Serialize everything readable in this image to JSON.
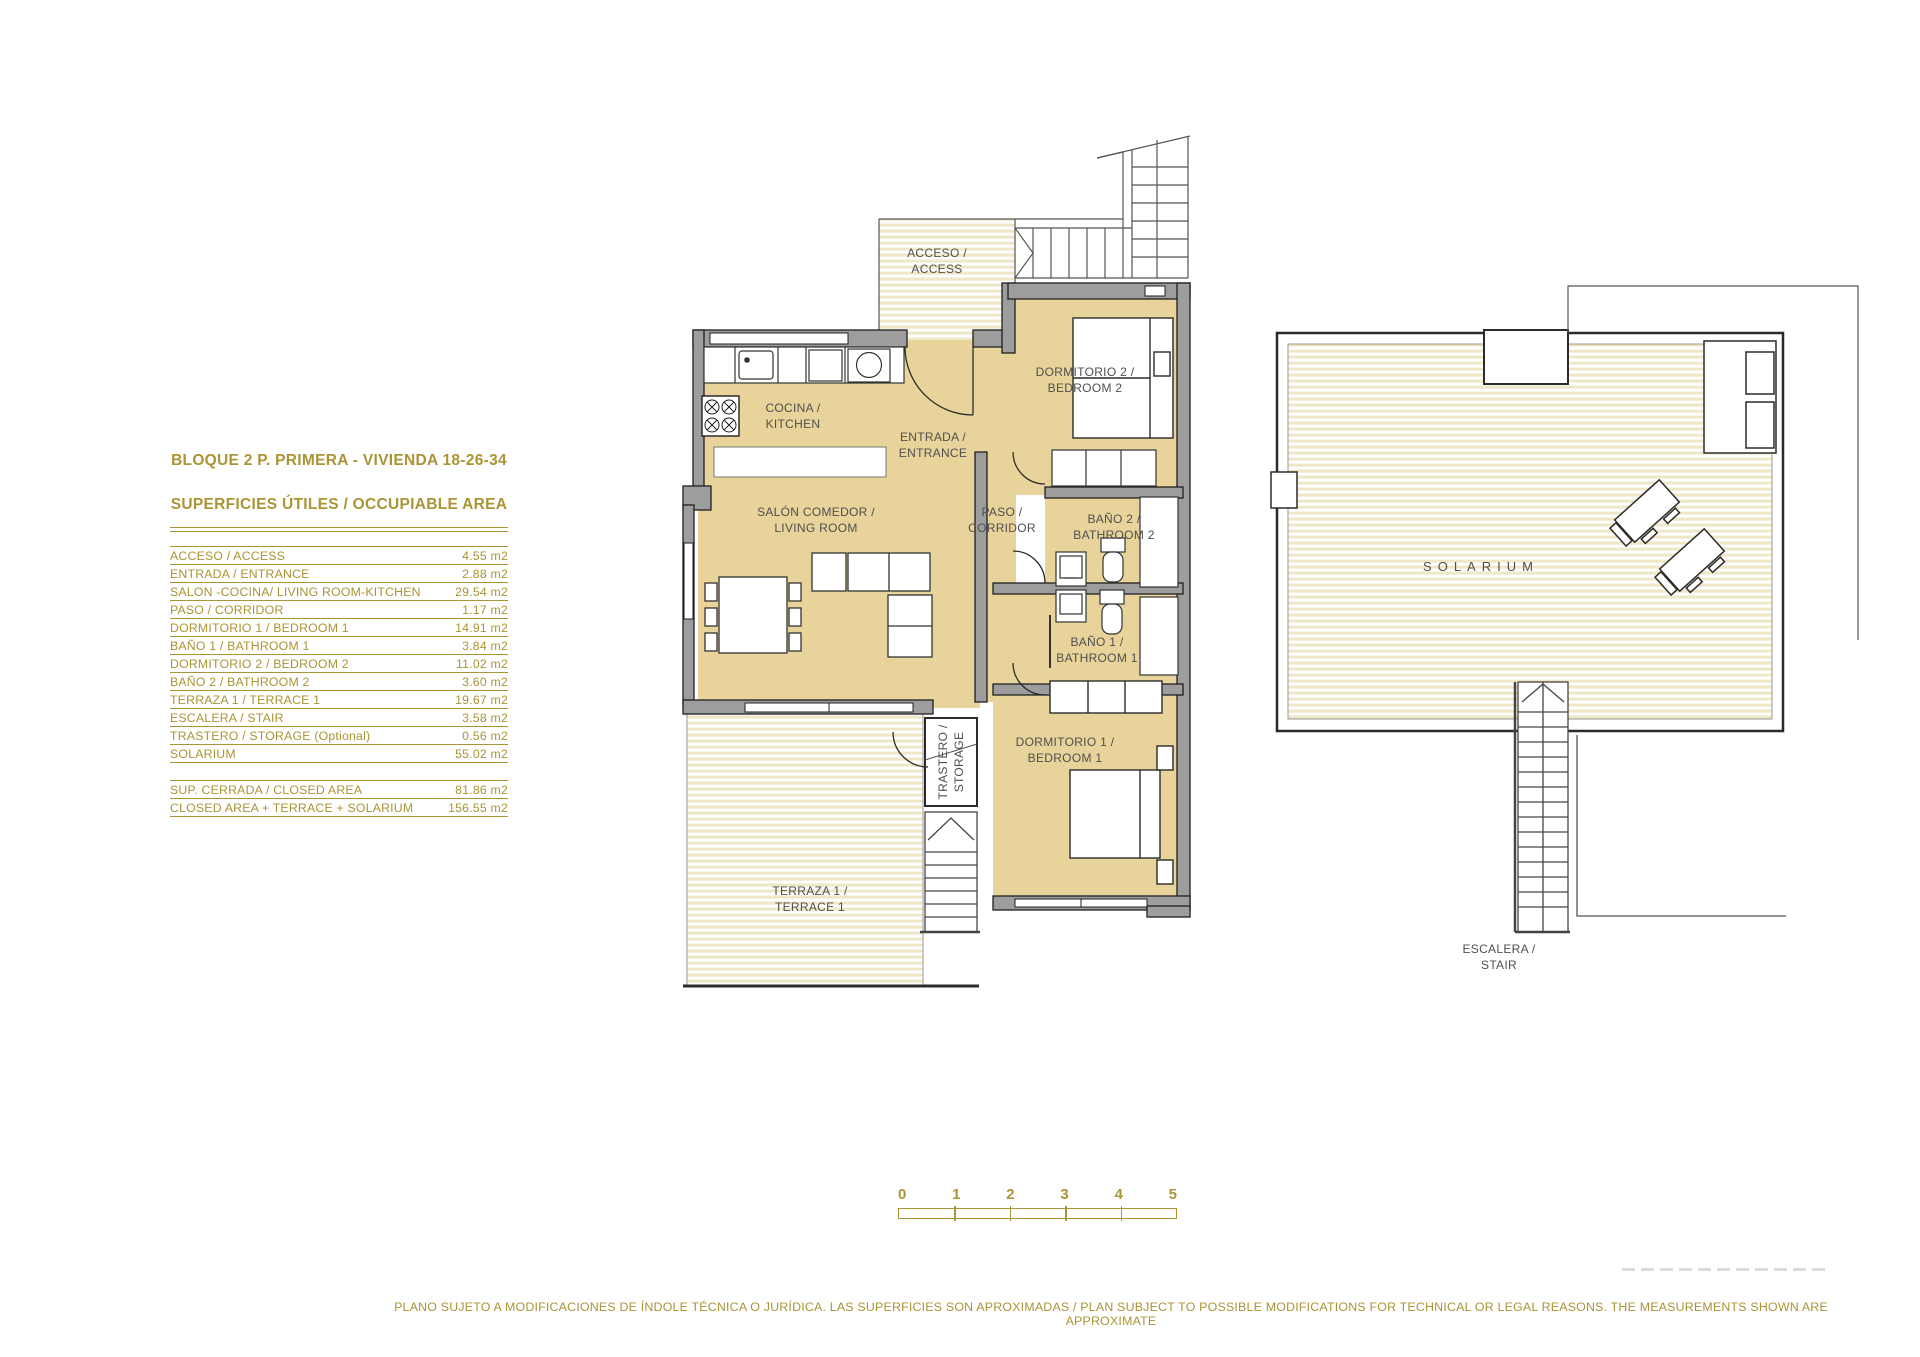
{
  "title": {
    "line1": "BLOQUE 2  P. PRIMERA - VIVIENDA 18-26-34",
    "line2": "SUPERFICIES ÚTILES / OCCUPIABLE  AREA"
  },
  "area_table": {
    "rows": [
      {
        "label": "ACCESO / ACCESS",
        "value": "4.55 m2"
      },
      {
        "label": "ENTRADA / ENTRANCE",
        "value": "2.88 m2"
      },
      {
        "label": "SALON -COCINA/ LIVING ROOM-KITCHEN",
        "value": "29.54 m2"
      },
      {
        "label": "PASO / CORRIDOR",
        "value": "1.17 m2"
      },
      {
        "label": "DORMITORIO 1 /  BEDROOM 1",
        "value": "14.91 m2"
      },
      {
        "label": "BAÑO 1 / BATHROOM 1",
        "value": "3.84 m2"
      },
      {
        "label": "DORMITORIO 2 / BEDROOM 2",
        "value": "11.02 m2"
      },
      {
        "label": "BAÑO 2 / BATHROOM 2",
        "value": "3.60 m2"
      },
      {
        "label": "TERRAZA 1 / TERRACE 1",
        "value": "19.67 m2"
      },
      {
        "label": "ESCALERA / STAIR",
        "value": "3.58 m2"
      },
      {
        "label": "TRASTERO / STORAGE (Optional)",
        "value": "0.56 m2"
      },
      {
        "label": "SOLARIUM",
        "value": "55.02 m2"
      }
    ],
    "summary_rows": [
      {
        "label": "SUP. CERRADA / CLOSED AREA",
        "value": "81.86 m2"
      },
      {
        "label": "CLOSED AREA + TERRACE + SOLARIUM",
        "value": "156.55 m2"
      }
    ]
  },
  "plan": {
    "rooms": {
      "acceso": "ACCESO /\nACCESS",
      "cocina": "COCINA /\nKITCHEN",
      "entrada": "ENTRADA /\nENTRANCE",
      "salon": "SALÓN COMEDOR /\nLIVING ROOM",
      "paso": "PASO /\nCORRIDOR",
      "dormitorio2": "DORMITORIO 2 /\nBEDROOM 2",
      "bano2": "BAÑO 2 /\nBATHROOM 2",
      "bano1": "BAÑO 1 /\nBATHROOM 1",
      "dormitorio1": "DORMITORIO 1 /\nBEDROOM 1",
      "trastero": "TRASTERO /\nSTORAGE",
      "terraza": "TERRAZA 1 /\nTERRACE 1",
      "solarium": "SOLARIUM",
      "escalera": "ESCALERA /\nSTAIR"
    }
  },
  "scale_bar": {
    "ticks": [
      "0",
      "1",
      "2",
      "3",
      "4",
      "5"
    ]
  },
  "disclaimer": "PLANO SUJETO A MODIFICACIONES DE ÍNDOLE TÉCNICA O JURÍDICA. LAS SUPERFICIES SON APROXIMADAS / PLAN SUBJECT TO POSSIBLE MODIFICATIONS FOR TECHNICAL OR LEGAL REASONS. THE MEASUREMENTS SHOWN ARE APPROXIMATE",
  "colors": {
    "gold": "#ab9434",
    "room_fill": "#e8d49a",
    "stripe": "#efe7c6",
    "wall_gray": "#9d9d9d",
    "label_gray": "#4f4f4f"
  }
}
